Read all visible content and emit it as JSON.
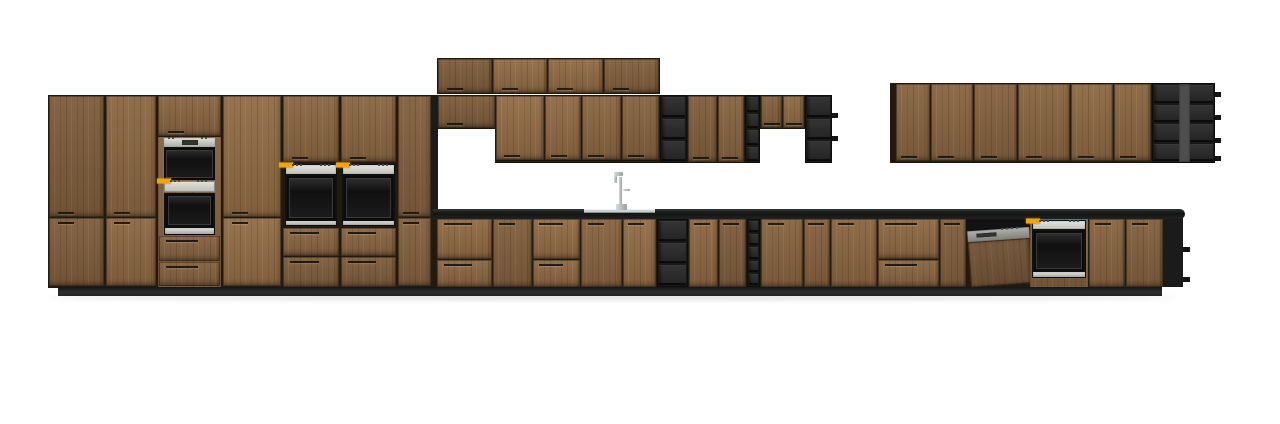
{
  "canvas": {
    "width": 1280,
    "height": 424,
    "background": "#ffffff"
  },
  "colors": {
    "bg": "#ffffff",
    "wood": "#85623f",
    "carcass": "#22190f",
    "black": "#1b1b1b",
    "display": "#efa60e"
  },
  "scene": {
    "description": "front elevation render of a kitchen: wood-fronted tall run with built-in ovens, wall cabinets with black open shelving, sink run with faucet, dishwasher and base oven",
    "items": [
      {
        "n": "floor-shadow",
        "k": "shadow",
        "r": [
          48,
          295,
          1130,
          5
        ]
      },
      {
        "n": "tall-run-carcass",
        "k": "run",
        "r": [
          48,
          95,
          385,
          193
        ]
      },
      {
        "n": "upper-stack-carcass",
        "k": "run",
        "r": [
          437,
          58,
          223,
          36
        ]
      },
      {
        "n": "midwall-carcass-short-left",
        "k": "run",
        "r": [
          437,
          95,
          59,
          34
        ]
      },
      {
        "n": "midwall-carcass-main",
        "k": "run",
        "r": [
          495,
          95,
          165,
          68
        ]
      },
      {
        "n": "midwall-carcass-right",
        "k": "run",
        "r": [
          687,
          95,
          58,
          68
        ]
      },
      {
        "n": "midwall-carcass-short-right",
        "k": "run",
        "r": [
          760,
          95,
          45,
          34
        ]
      },
      {
        "n": "rightwall-carcass",
        "k": "run",
        "r": [
          890,
          83,
          325,
          80
        ]
      },
      {
        "n": "base-run-carcass",
        "k": "run",
        "r": [
          433,
          218,
          750,
          69
        ]
      },
      {
        "n": "plinth",
        "k": "plinth",
        "r": [
          58,
          287,
          1104,
          9
        ]
      },
      {
        "n": "tall-run-end-panel",
        "k": "dark",
        "r": [
          431,
          95,
          7,
          123
        ]
      },
      {
        "n": "countertop",
        "k": "counter",
        "r": [
          433,
          209,
          752,
          10
        ]
      },
      {
        "n": "tall-door-1",
        "k": "door h-b",
        "r": [
          49,
          96,
          55,
          121
        ]
      },
      {
        "n": "tall-door-2",
        "k": "door h-b",
        "r": [
          106,
          96,
          50,
          121
        ]
      },
      {
        "n": "oven-tower-top-door",
        "k": "door h-b",
        "r": [
          158,
          96,
          63,
          40
        ]
      },
      {
        "n": "tall-door-3",
        "k": "door h-b",
        "r": [
          223,
          96,
          58,
          121
        ]
      },
      {
        "n": "above-wall-oven-door-left",
        "k": "door h-b",
        "r": [
          283,
          96,
          56,
          66
        ]
      },
      {
        "n": "above-wall-oven-door-right",
        "k": "door h-b",
        "r": [
          341,
          96,
          55,
          66
        ]
      },
      {
        "n": "tall-door-4",
        "k": "door h-b",
        "r": [
          398,
          96,
          33,
          121
        ]
      },
      {
        "n": "tall-lower-door-1",
        "k": "door h-t",
        "r": [
          49,
          218,
          55,
          68
        ]
      },
      {
        "n": "tall-lower-door-2",
        "k": "door h-t",
        "r": [
          106,
          218,
          50,
          68
        ]
      },
      {
        "n": "tall-lower-door-3",
        "k": "door h-t",
        "r": [
          223,
          218,
          58,
          68
        ]
      },
      {
        "n": "tall-lower-door-4",
        "k": "door h-t",
        "r": [
          398,
          218,
          33,
          68
        ]
      },
      {
        "n": "oven-tower-filler",
        "k": "wood",
        "r": [
          158,
          137,
          63,
          150
        ]
      },
      {
        "n": "compact-oven",
        "k": "compact",
        "r": [
          164,
          138,
          51,
          42
        ]
      },
      {
        "n": "oven-control-strip",
        "k": "cstrip",
        "r": [
          164,
          181,
          51,
          11
        ]
      },
      {
        "n": "tall-oven",
        "k": "oven",
        "r": [
          164,
          193,
          51,
          42
        ],
        "p": 0,
        "s": 7
      },
      {
        "n": "oven-tower-drawer-1",
        "k": "drawer h-t",
        "r": [
          159,
          236,
          61,
          25
        ]
      },
      {
        "n": "oven-tower-drawer-2",
        "k": "drawer h-t",
        "r": [
          159,
          262,
          61,
          24
        ]
      },
      {
        "n": "wall-oven-left",
        "k": "oven",
        "r": [
          285,
          164,
          52,
          62
        ],
        "p": 11,
        "s": 5
      },
      {
        "n": "wall-oven-right",
        "k": "oven",
        "r": [
          342,
          164,
          53,
          62
        ],
        "p": 11,
        "s": 5
      },
      {
        "n": "below-oven-drawer-l1",
        "k": "drawer h-t",
        "r": [
          283,
          228,
          56,
          28
        ]
      },
      {
        "n": "below-oven-drawer-l2",
        "k": "drawer h-t",
        "r": [
          283,
          257,
          56,
          30
        ]
      },
      {
        "n": "below-oven-drawer-r1",
        "k": "drawer h-t",
        "r": [
          341,
          228,
          55,
          28
        ]
      },
      {
        "n": "below-oven-drawer-r2",
        "k": "drawer h-t",
        "r": [
          341,
          257,
          55,
          30
        ]
      },
      {
        "n": "upper-stack-door-1",
        "k": "door h-b",
        "r": [
          438,
          59,
          54,
          34
        ]
      },
      {
        "n": "upper-stack-door-2",
        "k": "door h-b",
        "r": [
          493,
          59,
          54,
          34
        ]
      },
      {
        "n": "upper-stack-door-3",
        "k": "door h-b",
        "r": [
          548,
          59,
          55,
          34
        ]
      },
      {
        "n": "upper-stack-door-4",
        "k": "door h-b",
        "r": [
          604,
          59,
          55,
          34
        ]
      },
      {
        "n": "midwall-short-door-left",
        "k": "door h-b",
        "r": [
          438,
          96,
          57,
          32
        ]
      },
      {
        "n": "midwall-door-1",
        "k": "door h-b",
        "r": [
          496,
          96,
          48,
          64
        ]
      },
      {
        "n": "midwall-door-2",
        "k": "door h-b",
        "r": [
          545,
          96,
          36,
          64
        ]
      },
      {
        "n": "midwall-door-3",
        "k": "door h-b",
        "r": [
          582,
          96,
          39,
          64
        ]
      },
      {
        "n": "midwall-door-4",
        "k": "door h-b",
        "r": [
          622,
          96,
          37,
          64
        ]
      },
      {
        "n": "open-shelf-wall-1",
        "k": "shelves",
        "r": [
          660,
          95,
          27,
          68
        ],
        "rows": 3
      },
      {
        "n": "midwall-door-5",
        "k": "door h-b",
        "r": [
          688,
          96,
          29,
          66
        ]
      },
      {
        "n": "midwall-door-6",
        "k": "door h-b",
        "r": [
          718,
          96,
          26,
          66
        ]
      },
      {
        "n": "open-shelf-wall-narrow",
        "k": "shelves",
        "r": [
          745,
          95,
          15,
          68
        ],
        "rows": 4
      },
      {
        "n": "midwall-short-door-r1",
        "k": "door h-b",
        "r": [
          761,
          96,
          21,
          32
        ]
      },
      {
        "n": "midwall-short-door-r2",
        "k": "door h-b",
        "r": [
          783,
          96,
          21,
          32
        ]
      },
      {
        "n": "open-shelf-wall-2",
        "k": "shelves",
        "r": [
          805,
          95,
          27,
          68
        ],
        "rows": 3
      },
      {
        "n": "shelf-tab-mid-1",
        "k": "tab",
        "r": [
          832,
          113,
          6,
          5
        ]
      },
      {
        "n": "shelf-tab-mid-2",
        "k": "tab",
        "r": [
          832,
          136,
          6,
          5
        ]
      },
      {
        "n": "rightwall-door-1",
        "k": "door h-b",
        "r": [
          896,
          84,
          34,
          77
        ]
      },
      {
        "n": "rightwall-door-2",
        "k": "door h-b",
        "r": [
          931,
          84,
          42,
          77
        ]
      },
      {
        "n": "rightwall-door-3",
        "k": "door h-b",
        "r": [
          974,
          84,
          43,
          77
        ]
      },
      {
        "n": "rightwall-door-4",
        "k": "door h-b",
        "r": [
          1018,
          84,
          52,
          77
        ]
      },
      {
        "n": "rightwall-door-5",
        "k": "door h-b",
        "r": [
          1071,
          84,
          42,
          77
        ]
      },
      {
        "n": "rightwall-door-6",
        "k": "door h-b",
        "r": [
          1114,
          84,
          37,
          77
        ]
      },
      {
        "n": "open-shelf-right-wall",
        "k": "shelves",
        "r": [
          1152,
          83,
          63,
          80
        ],
        "rows": 4,
        "cols": 2
      },
      {
        "n": "open-shelf-right-divider",
        "k": "divider",
        "r": [
          1179,
          84,
          11,
          78
        ]
      },
      {
        "n": "shelf-tab-right-1",
        "k": "tab",
        "r": [
          1215,
          92,
          6,
          5
        ]
      },
      {
        "n": "shelf-tab-right-2",
        "k": "tab",
        "r": [
          1215,
          115,
          6,
          5
        ]
      },
      {
        "n": "shelf-tab-right-3",
        "k": "tab",
        "r": [
          1215,
          138,
          6,
          5
        ]
      },
      {
        "n": "shelf-tab-right-4",
        "k": "tab",
        "r": [
          1215,
          156,
          6,
          5
        ]
      },
      {
        "n": "base-drawer-1a",
        "k": "drawer h-t",
        "r": [
          437,
          219,
          55,
          40
        ]
      },
      {
        "n": "base-drawer-1b",
        "k": "drawer h-t",
        "r": [
          437,
          260,
          55,
          27
        ]
      },
      {
        "n": "base-door-1",
        "k": "door h-t",
        "r": [
          493,
          219,
          39,
          68
        ]
      },
      {
        "n": "base-drawer-2a",
        "k": "drawer h-t",
        "r": [
          533,
          219,
          47,
          40
        ]
      },
      {
        "n": "base-drawer-2b",
        "k": "drawer h-t",
        "r": [
          533,
          260,
          47,
          27
        ]
      },
      {
        "n": "base-door-2",
        "k": "door h-t",
        "r": [
          581,
          219,
          41,
          68
        ]
      },
      {
        "n": "base-door-3",
        "k": "door h-t",
        "r": [
          623,
          219,
          33,
          68
        ]
      },
      {
        "n": "open-shelf-base-1",
        "k": "shelves",
        "r": [
          657,
          219,
          31,
          68
        ],
        "rows": 3
      },
      {
        "n": "base-door-4",
        "k": "door h-t",
        "r": [
          689,
          219,
          29,
          68
        ]
      },
      {
        "n": "base-door-5",
        "k": "door h-t",
        "r": [
          719,
          219,
          27,
          68
        ]
      },
      {
        "n": "open-shelf-base-narrow",
        "k": "shelves",
        "r": [
          747,
          219,
          13,
          68
        ],
        "rows": 5
      },
      {
        "n": "base-door-6",
        "k": "door h-t",
        "r": [
          761,
          219,
          42,
          68
        ]
      },
      {
        "n": "base-door-7",
        "k": "door h-t",
        "r": [
          804,
          219,
          26,
          68
        ]
      },
      {
        "n": "base-door-8",
        "k": "door h-t",
        "r": [
          831,
          219,
          46,
          68
        ]
      },
      {
        "n": "base-drawer-3a",
        "k": "drawer h-t",
        "r": [
          878,
          219,
          61,
          40
        ]
      },
      {
        "n": "base-drawer-3b",
        "k": "drawer h-t",
        "r": [
          878,
          260,
          61,
          27
        ]
      },
      {
        "n": "base-door-9",
        "k": "door h-t",
        "r": [
          940,
          219,
          26,
          68
        ]
      },
      {
        "n": "dishwasher",
        "k": "dw",
        "r": [
          966,
          219,
          64,
          66
        ]
      },
      {
        "n": "base-oven-filler",
        "k": "wood",
        "r": [
          1030,
          219,
          58,
          68
        ]
      },
      {
        "n": "base-oven",
        "k": "oven",
        "r": [
          1032,
          220,
          54,
          58
        ],
        "p": 10,
        "s": 6
      },
      {
        "n": "base-door-10",
        "k": "door h-t",
        "r": [
          1089,
          219,
          36,
          68
        ]
      },
      {
        "n": "base-door-11",
        "k": "door h-t",
        "r": [
          1126,
          219,
          37,
          68
        ]
      },
      {
        "n": "base-end-panel",
        "k": "dark",
        "r": [
          1164,
          219,
          19,
          68
        ]
      },
      {
        "n": "base-end-tab-1",
        "k": "tab",
        "r": [
          1183,
          247,
          7,
          5
        ]
      },
      {
        "n": "base-end-tab-2",
        "k": "tab",
        "r": [
          1183,
          277,
          7,
          5
        ]
      },
      {
        "n": "sink",
        "k": "sink",
        "r": [
          584,
          209,
          71,
          4
        ]
      },
      {
        "n": "faucet",
        "k": "faucet",
        "r": [
          610,
          171,
          22,
          40
        ]
      }
    ]
  }
}
